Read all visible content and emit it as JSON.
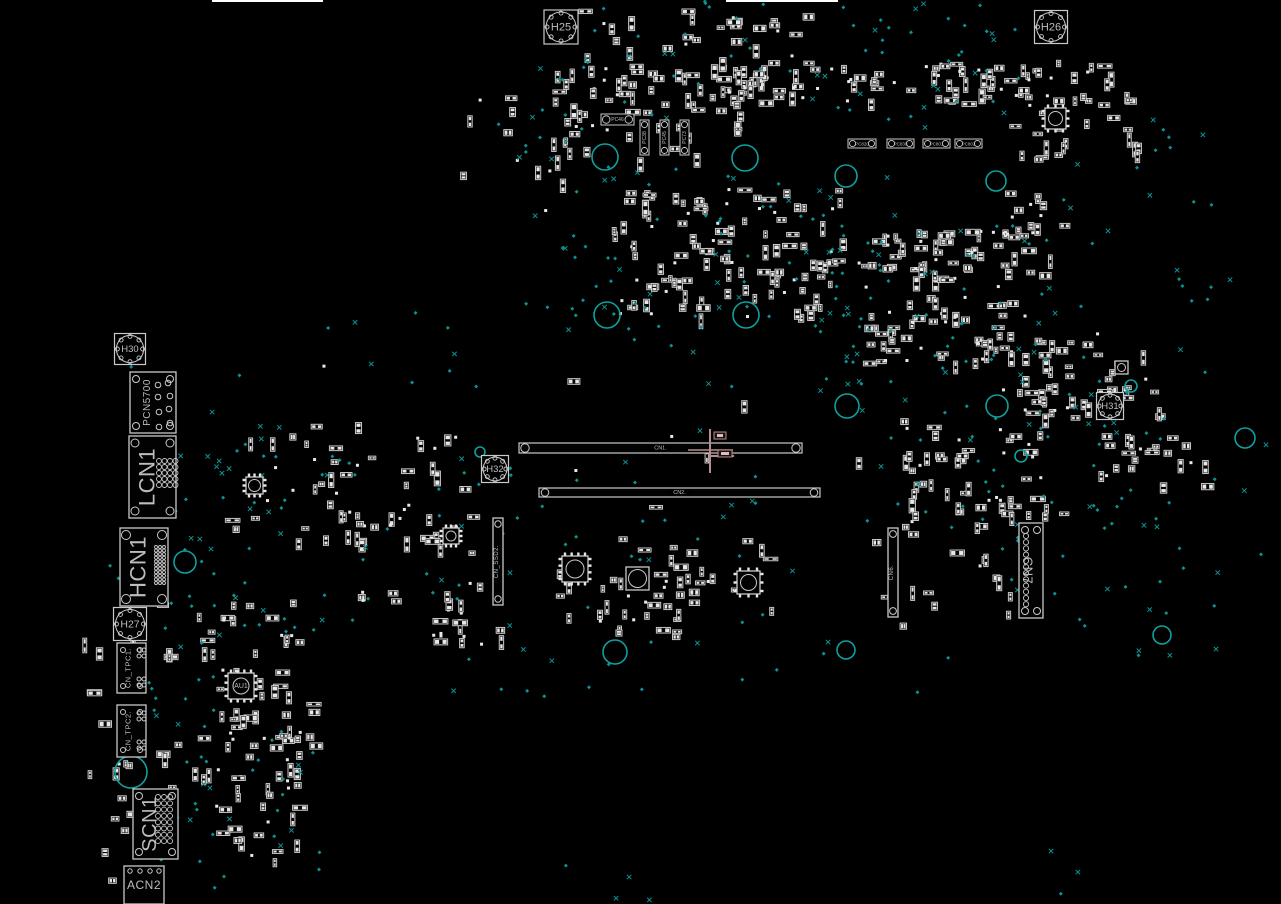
{
  "canvas": {
    "w": 1281,
    "h": 904,
    "bg": "#000000"
  },
  "colors": {
    "outline": "#c9c9c9",
    "bright": "#e8e8e8",
    "label": "#bdbdbd",
    "teal": "#0d9191",
    "ring": "#0fa0a0",
    "pink": "#b98d8d"
  },
  "top_lines": [
    {
      "x1": 212,
      "x2": 323,
      "y": 1
    },
    {
      "x1": 726,
      "x2": 838,
      "y": 1
    }
  ],
  "holes": [
    {
      "label": "H25",
      "cx": 561,
      "cy": 27,
      "size": 34,
      "fs": 11
    },
    {
      "label": "H26",
      "cx": 1051,
      "cy": 27,
      "size": 33,
      "fs": 11
    },
    {
      "label": "H30",
      "cx": 130,
      "cy": 349,
      "size": 31,
      "fs": 9.5
    },
    {
      "label": "H27",
      "cx": 130,
      "cy": 624,
      "size": 33,
      "fs": 10.5
    },
    {
      "label": "H31",
      "cx": 1110,
      "cy": 406,
      "size": 27,
      "fs": 9.5
    },
    {
      "label": "H32",
      "cx": 495,
      "cy": 469,
      "size": 27,
      "fs": 9.5
    }
  ],
  "connectors": [
    {
      "label": "PCN5700",
      "x": 130,
      "y": 372,
      "w": 46,
      "h": 61,
      "fs": 10,
      "rot": -90,
      "corners": 3.5,
      "dots": [
        [
          158,
          385
        ],
        [
          168,
          383
        ],
        [
          170,
          396
        ],
        [
          158,
          397
        ],
        [
          169,
          409
        ],
        [
          159,
          412
        ],
        [
          170,
          423
        ],
        [
          159,
          427
        ]
      ],
      "dot_r": 2.8
    },
    {
      "label": "LCN1",
      "x": 129,
      "y": 436,
      "w": 47,
      "h": 82,
      "fs": 22,
      "rot": -90,
      "corners": 4,
      "grid": {
        "x0": 159,
        "y0": 461,
        "cols": 4,
        "rows": 5,
        "dx": 5.5,
        "dy": 6,
        "r": 2.5
      }
    },
    {
      "label": "HCN1",
      "x": 120,
      "y": 528,
      "w": 48,
      "h": 78,
      "fs": 22,
      "rot": -90,
      "corners": 4.5,
      "grid": {
        "x0": 156,
        "y0": 547,
        "cols": 3,
        "rows": 11,
        "dx": 4,
        "dy": 3.6,
        "r": 1.5
      }
    },
    {
      "label": "CN_TPC1.",
      "x": 117,
      "y": 643,
      "w": 29,
      "h": 50,
      "fs": 7.5,
      "rot": -90,
      "corners": 2.5,
      "dots": [
        [
          139,
          650
        ],
        [
          144,
          650
        ],
        [
          139,
          656
        ],
        [
          144,
          656
        ],
        [
          139,
          679
        ],
        [
          144,
          679
        ],
        [
          139,
          685
        ],
        [
          144,
          685
        ]
      ],
      "dot_r": 2
    },
    {
      "label": "CN_TPC2.",
      "x": 117,
      "y": 705,
      "w": 29,
      "h": 52,
      "fs": 7.5,
      "rot": -90,
      "corners": 2.5,
      "dots": [
        [
          139,
          713
        ],
        [
          144,
          713
        ],
        [
          139,
          719
        ],
        [
          144,
          719
        ],
        [
          139,
          742
        ],
        [
          144,
          742
        ],
        [
          139,
          748
        ],
        [
          144,
          748
        ]
      ],
      "dot_r": 2
    },
    {
      "label": "SCN1",
      "x": 133,
      "y": 789,
      "w": 45,
      "h": 70,
      "fs": 20,
      "rot": -90,
      "corners": 3.5,
      "grid": {
        "x0": 158,
        "y0": 797,
        "cols": 3,
        "rows": 8,
        "dx": 6,
        "dy": 6.3,
        "r": 2.5
      }
    },
    {
      "label": "ACN2",
      "x": 124,
      "y": 866,
      "w": 40,
      "h": 38,
      "fs": 12,
      "rot": 0,
      "corners": 0,
      "dots": [
        [
          130,
          871
        ],
        [
          140,
          871
        ],
        [
          150,
          871
        ],
        [
          159,
          871
        ]
      ],
      "dot_r": 2.2
    },
    {
      "label": "CN7",
      "x": 1019,
      "y": 523,
      "w": 24,
      "h": 95,
      "fs": 13,
      "rot": 90,
      "corners": 3.5,
      "grid": {
        "x0": 1026,
        "y0": 536,
        "cols": 1,
        "rows": 12,
        "dx": 0,
        "dy": 6.2,
        "r": 2.6
      }
    },
    {
      "label": "CN_SSD2.",
      "x": 493,
      "y": 518,
      "w": 10,
      "h": 87,
      "fs": 6,
      "rot": -90,
      "corners": 0,
      "dots": [
        [
          498,
          524
        ],
        [
          498,
          599
        ]
      ],
      "dot_r": 3.2
    },
    {
      "label": "CN6.",
      "x": 888,
      "y": 528,
      "w": 10,
      "h": 89,
      "fs": 6,
      "rot": -90,
      "corners": 0,
      "dots": [
        [
          893,
          534
        ],
        [
          893,
          611
        ]
      ],
      "dot_r": 3.4
    }
  ],
  "slots": [
    {
      "label": "CN1.",
      "x": 519,
      "y": 443,
      "w": 283,
      "h": 10,
      "fs": 5.5
    },
    {
      "label": "CN2.",
      "x": 539,
      "y": 488,
      "w": 281,
      "h": 9,
      "fs": 5.5
    }
  ],
  "tiny_connectors": [
    {
      "label": "PC46",
      "x": 601,
      "y": 114,
      "w": 33,
      "h": 11,
      "orient": "h",
      "fs": 5
    },
    {
      "label": "PC38",
      "x": 640,
      "y": 120,
      "w": 9,
      "h": 35,
      "orient": "v",
      "fs": 5
    },
    {
      "label": "PC45",
      "x": 660,
      "y": 120,
      "w": 9,
      "h": 35,
      "orient": "v",
      "fs": 5
    },
    {
      "label": "PC73",
      "x": 680,
      "y": 120,
      "w": 9,
      "h": 35,
      "orient": "v",
      "fs": 5
    },
    {
      "label": "PC820",
      "x": 848,
      "y": 139,
      "w": 28,
      "h": 9,
      "orient": "h",
      "fs": 4.5
    },
    {
      "label": "PC830",
      "x": 887,
      "y": 139,
      "w": 27,
      "h": 9,
      "orient": "h",
      "fs": 4.5
    },
    {
      "label": "PC801",
      "x": 923,
      "y": 139,
      "w": 27,
      "h": 9,
      "orient": "h",
      "fs": 4.5
    },
    {
      "label": "PC802",
      "x": 955,
      "y": 139,
      "w": 27,
      "h": 9,
      "orient": "h",
      "fs": 4.5
    }
  ],
  "chips": [
    {
      "label": "AU1",
      "x": 228,
      "y": 673,
      "size": 26,
      "r": 8,
      "fs": 7,
      "pins": true
    },
    {
      "label": "",
      "x": 562,
      "y": 556,
      "size": 26,
      "r": 9,
      "fs": 0,
      "pins": true
    },
    {
      "label": "",
      "x": 626,
      "y": 567,
      "size": 23,
      "r": 9,
      "fs": 0,
      "pins": false
    },
    {
      "label": "",
      "x": 737,
      "y": 571,
      "size": 23,
      "r": 8,
      "fs": 0,
      "pins": true
    },
    {
      "label": "",
      "x": 1045,
      "y": 108,
      "size": 21,
      "r": 7,
      "fs": 0,
      "pins": true
    },
    {
      "label": "",
      "x": 246,
      "y": 477,
      "size": 17,
      "r": 6,
      "fs": 0,
      "pins": true
    },
    {
      "label": "",
      "x": 443,
      "y": 528,
      "size": 16,
      "r": 5,
      "fs": 0,
      "pins": true
    },
    {
      "label": "",
      "x": 1115,
      "y": 361,
      "size": 13,
      "r": 4,
      "fs": 0,
      "pins": false
    }
  ],
  "rings": [
    {
      "cx": 605,
      "cy": 157,
      "r": 13
    },
    {
      "cx": 745,
      "cy": 158,
      "r": 13
    },
    {
      "cx": 846,
      "cy": 176,
      "r": 11
    },
    {
      "cx": 996,
      "cy": 181,
      "r": 10
    },
    {
      "cx": 607,
      "cy": 315,
      "r": 13
    },
    {
      "cx": 746,
      "cy": 315,
      "r": 13
    },
    {
      "cx": 847,
      "cy": 406,
      "r": 12
    },
    {
      "cx": 997,
      "cy": 406,
      "r": 11
    },
    {
      "cx": 185,
      "cy": 562,
      "r": 11
    },
    {
      "cx": 131,
      "cy": 772,
      "r": 16
    },
    {
      "cx": 1131,
      "cy": 386,
      "r": 6
    },
    {
      "cx": 1245,
      "cy": 438,
      "r": 10
    },
    {
      "cx": 1162,
      "cy": 635,
      "r": 9
    },
    {
      "cx": 846,
      "cy": 650,
      "r": 9
    },
    {
      "cx": 615,
      "cy": 652,
      "r": 12
    },
    {
      "cx": 480,
      "cy": 452,
      "r": 5
    },
    {
      "cx": 1021,
      "cy": 456,
      "r": 6
    }
  ],
  "crosshair": {
    "v": {
      "x": 710,
      "y1": 429,
      "y2": 473
    },
    "h": {
      "y": 450,
      "x1": 688,
      "x2": 733
    },
    "h2": {
      "y": 456,
      "x1": 710,
      "x2": 734
    },
    "boxes": [
      [
        714,
        432,
        12,
        7
      ],
      [
        718,
        450,
        14,
        7
      ]
    ]
  },
  "noise": {
    "seed": 1337,
    "part_clusters": [
      [
        545,
        62,
        470,
        40,
        95
      ],
      [
        560,
        8,
        250,
        50,
        28
      ],
      [
        700,
        55,
        120,
        40,
        18
      ],
      [
        1008,
        58,
        130,
        100,
        45
      ],
      [
        612,
        188,
        230,
        128,
        115
      ],
      [
        855,
        228,
        170,
        135,
        105
      ],
      [
        1000,
        185,
        60,
        95,
        22
      ],
      [
        1008,
        332,
        150,
        85,
        48
      ],
      [
        215,
        430,
        250,
        110,
        40
      ],
      [
        330,
        510,
        160,
        110,
        28
      ],
      [
        540,
        535,
        230,
        95,
        40
      ],
      [
        150,
        598,
        150,
        190,
        55
      ],
      [
        210,
        690,
        100,
        170,
        45
      ],
      [
        425,
        598,
        280,
        45,
        16
      ],
      [
        895,
        425,
        170,
        100,
        42
      ],
      [
        1095,
        430,
        120,
        55,
        22
      ],
      [
        300,
        345,
        760,
        260,
        35
      ],
      [
        460,
        80,
        120,
        130,
        15
      ],
      [
        80,
        630,
        55,
        260,
        18
      ],
      [
        900,
        495,
        120,
        130,
        20
      ],
      [
        545,
        100,
        200,
        60,
        25
      ]
    ],
    "point_clusters": [
      [
        540,
        0,
        480,
        130,
        70
      ],
      [
        560,
        165,
        330,
        170,
        65
      ],
      [
        820,
        215,
        230,
        170,
        55
      ],
      [
        170,
        425,
        280,
        210,
        45
      ],
      [
        140,
        595,
        190,
        270,
        55
      ],
      [
        420,
        430,
        420,
        200,
        40
      ],
      [
        860,
        380,
        300,
        150,
        45
      ],
      [
        1040,
        100,
        200,
        300,
        30
      ],
      [
        300,
        300,
        900,
        100,
        25
      ],
      [
        450,
        640,
        500,
        60,
        18
      ],
      [
        100,
        330,
        150,
        280,
        20
      ],
      [
        980,
        500,
        220,
        160,
        25
      ],
      [
        1150,
        400,
        120,
        260,
        12
      ],
      [
        200,
        850,
        900,
        50,
        10
      ],
      [
        480,
        60,
        100,
        250,
        15
      ]
    ]
  }
}
